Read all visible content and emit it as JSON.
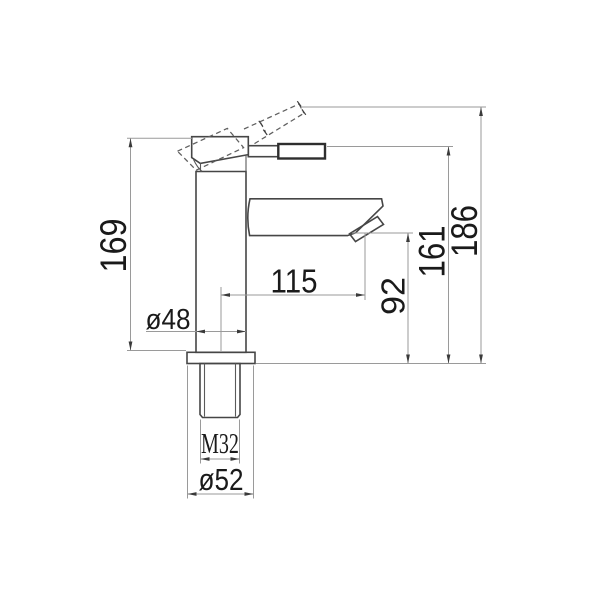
{
  "drawing": {
    "background_color": "#ffffff",
    "object_line_color": "#464646",
    "dimension_line_color": "#9a9a9a",
    "text_color": "#1a1a1a",
    "dims": {
      "height": "169",
      "body_diameter": "ø48",
      "reach": "115",
      "outlet_height": "92",
      "handle_height": "161",
      "overall_height": "186",
      "thread": "M32",
      "base_diameter": "ø52"
    }
  }
}
